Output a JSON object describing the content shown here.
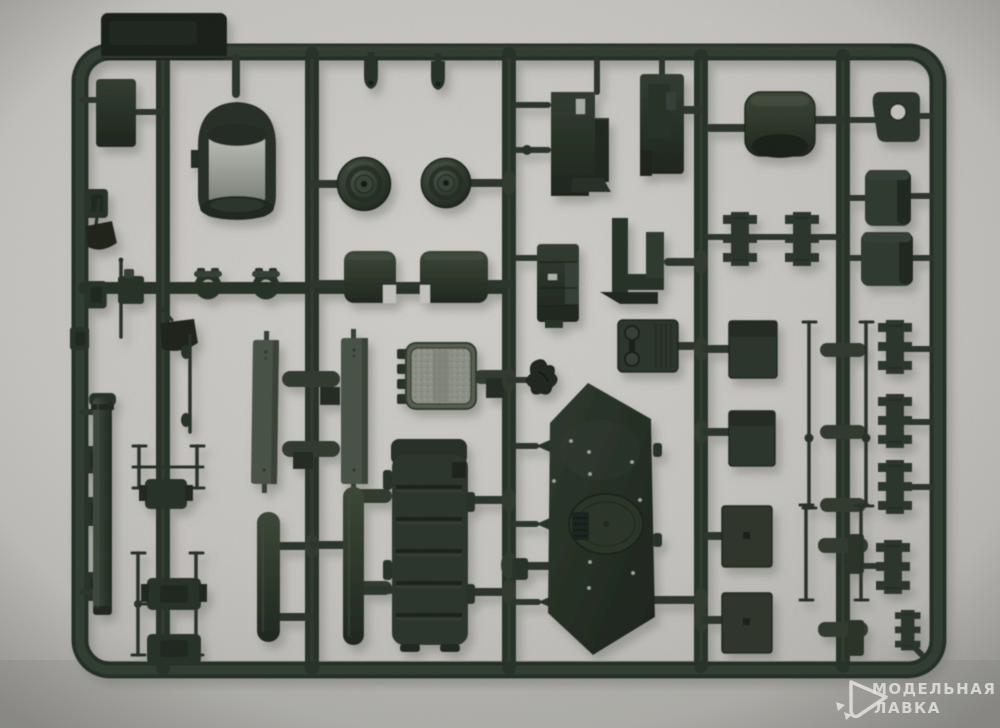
{
  "image": {
    "type": "photograph",
    "subject": "Injection-molded plastic model kit sprue with dark olive-green parts on runners, photographed on a light gray surface",
    "background_color": "#c9c8c4",
    "plastic_color": "#2e372e",
    "sprue_label_tab": "embossed text not legible"
  },
  "watermark": {
    "logo": "modelnaya-lavka-triangle-logo",
    "line1": "МОДЕЛЬНАЯ",
    "line2": "ЛАВКА",
    "color": "#eae9e5"
  }
}
